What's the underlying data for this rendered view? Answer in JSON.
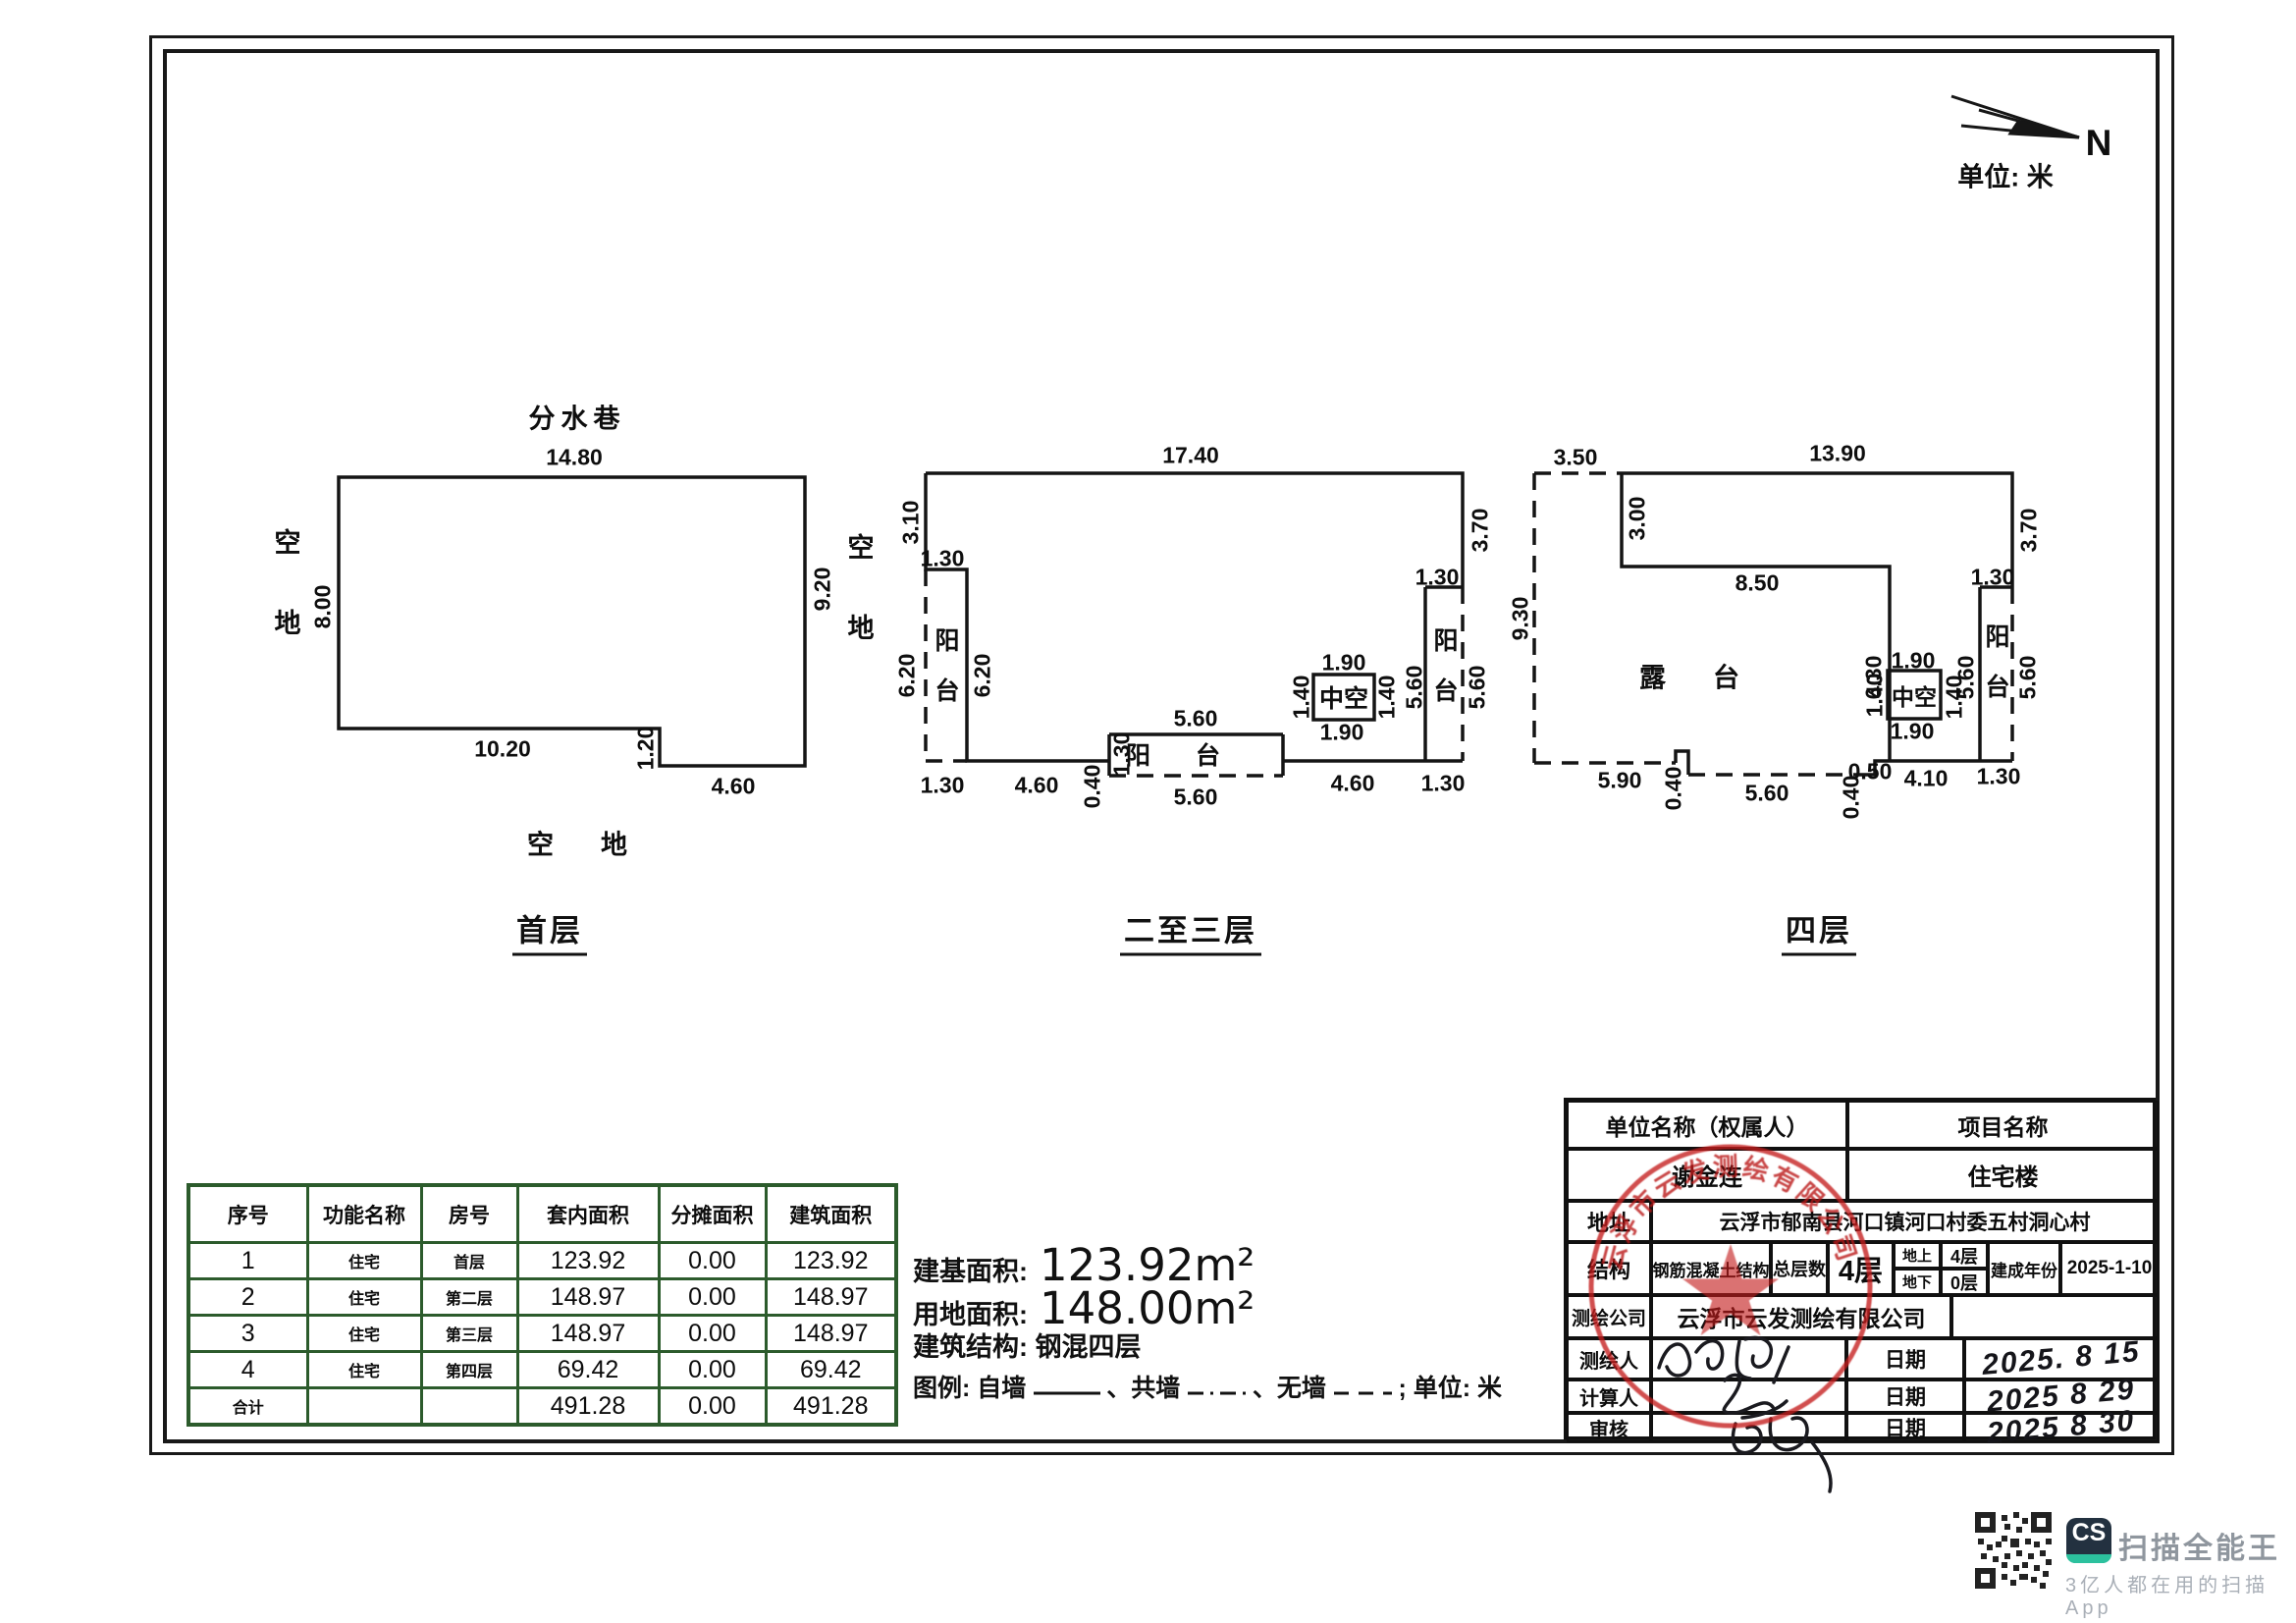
{
  "page": {
    "unit_note": "单位: 米",
    "north": "N"
  },
  "plans": [
    {
      "title": "首层",
      "street": "分水巷",
      "open_left": "空地",
      "open_bottom": "空地",
      "dims": {
        "top": "14.80",
        "left": "8.00",
        "right": "9.20",
        "bottom1": "10.20",
        "step": "1.20",
        "bottom2": "4.60"
      }
    },
    {
      "title": "二至三层",
      "open_left": "空地",
      "balcony_left": "阳台",
      "balcony_bottom": "阳台",
      "balcony_right": "阳台",
      "hollow": "中空",
      "dims": {
        "top": "17.40",
        "left_top": "3.10",
        "bal_l_w": "1.30",
        "bal_l_out": "6.20",
        "bal_l_in": "6.20",
        "bot1": "1.30",
        "bot2": "4.60",
        "step": "0.40",
        "bal_b_h": "1.30",
        "bal_b_top": "5.60",
        "bal_b_bot": "5.60",
        "bot3": "4.60",
        "bot4": "1.30",
        "right_top": "3.70",
        "bal_r_w": "1.30",
        "bal_r_in": "5.60",
        "bal_r_out": "5.60",
        "zk_top": "1.90",
        "zk_left": "1.40",
        "zk_right": "1.40",
        "zk_bottom": "1.90"
      }
    },
    {
      "title": "四层",
      "terrace": "露台",
      "balcony_right": "阳台",
      "hollow": "中空",
      "dims": {
        "top_dash": "3.50",
        "top": "13.90",
        "left_top": "3.00",
        "mid": "8.50",
        "mid_v": "6.30",
        "right_top": "3.70",
        "bal_r_w": "1.30",
        "bal_r_in": "5.60",
        "bal_r_out": "5.60",
        "left": "9.30",
        "bot1": "5.90",
        "notch1": "0.40",
        "bot2": "5.60",
        "notch2": "0.40",
        "notch3": "0.50",
        "bot3": "4.10",
        "bot4": "1.30",
        "zk_top": "1.90",
        "zk_left": "1.40",
        "zk_right": "1.40",
        "zk_bottom": "1.90"
      }
    }
  ],
  "table": {
    "headers": [
      "序号",
      "功能名称",
      "房号",
      "套内面积",
      "分摊面积",
      "建筑面积"
    ],
    "rows": [
      [
        "1",
        "住宅",
        "首层",
        "123.92",
        "0.00",
        "123.92"
      ],
      [
        "2",
        "住宅",
        "第二层",
        "148.97",
        "0.00",
        "148.97"
      ],
      [
        "3",
        "住宅",
        "第三层",
        "148.97",
        "0.00",
        "148.97"
      ],
      [
        "4",
        "住宅",
        "第四层",
        "69.42",
        "0.00",
        "69.42"
      ],
      [
        "合计",
        "",
        "",
        "491.28",
        "0.00",
        "491.28"
      ]
    ]
  },
  "info": {
    "area_label": "建基面积:",
    "area_value": "123.92m²",
    "land_label": "用地面积:",
    "land_value": "148.00m²",
    "structure": "建筑结构: 钢混四层",
    "legend_lead": "图例: 自墙",
    "legend_mid1": "、共墙",
    "legend_mid2": "、无墙",
    "legend_tail": ";  单位: 米"
  },
  "titleblock": {
    "owner_label": "单位名称（权属人）",
    "project_label": "项目名称",
    "owner": "谢金连",
    "project": "住宅楼",
    "addr_label": "地址",
    "addr": "云浮市郁南县河口镇河口村委五村洞心村",
    "struct_label": "结构",
    "struct": "钢筋混凝土结构",
    "floors_label": "总层数",
    "floors": "4层",
    "above_label": "地上",
    "above": "4层",
    "below_label": "地下",
    "below": "0层",
    "year_label": "建成年份",
    "year": "2025-1-10",
    "company_label": "测绘公司",
    "company": "云浮市云发测绘有限公司",
    "surveyor_label": "测绘人",
    "calc_label": "计算人",
    "review_label": "审核",
    "date_label": "日期",
    "date1": "2025. 8 15",
    "date2": "2025 8 29",
    "date3": "2025 8 30"
  },
  "stamp": {
    "arc_text": "云浮市云发测绘有限公司"
  },
  "watermark": {
    "logo": "CS",
    "title": "扫描全能王",
    "subtitle": "3亿人都在用的扫描App"
  }
}
